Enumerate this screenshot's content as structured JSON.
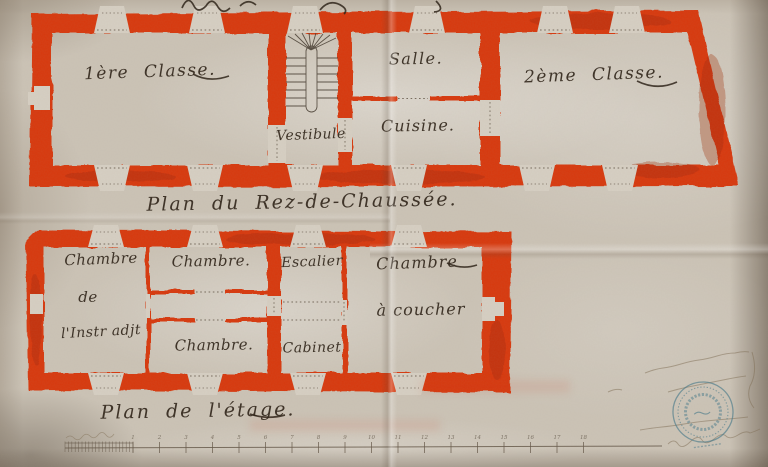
{
  "sheet": {
    "ground_floor": {
      "caption": "Plan du Rez-de-Chaussée.",
      "rooms": {
        "classe1": "1ère Classe.",
        "salle": "Salle.",
        "vestibule": "Vestibule",
        "cuisine": "Cuisine.",
        "classe2": "2ème Classe."
      }
    },
    "first_floor": {
      "caption": "Plan de l'étage.",
      "rooms": {
        "chambre_instituteur": [
          "Chambre",
          "de",
          "l'Instr adjt"
        ],
        "chambre_top": "Chambre.",
        "chambre_bottom": "Chambre.",
        "escalier": "Escalier",
        "cabinet": "Cabinet",
        "chambre_a_coucher": [
          "Chambre",
          "à coucher"
        ]
      }
    },
    "scale_bar": {
      "tick_labels": [
        "1",
        "2",
        "3",
        "4",
        "5",
        "6",
        "7",
        "8",
        "9",
        "10",
        "11",
        "12",
        "13",
        "14",
        "15",
        "16",
        "17",
        "18"
      ],
      "subdivisions": 10
    },
    "stamp": {
      "name": "circular-mairie-ink-stamp",
      "color": "#46798b"
    },
    "colors": {
      "wall_red": "#d73711",
      "ink": "#2e2318",
      "paper": "#cbc3b6",
      "stamp_blue": "#46798b"
    }
  }
}
